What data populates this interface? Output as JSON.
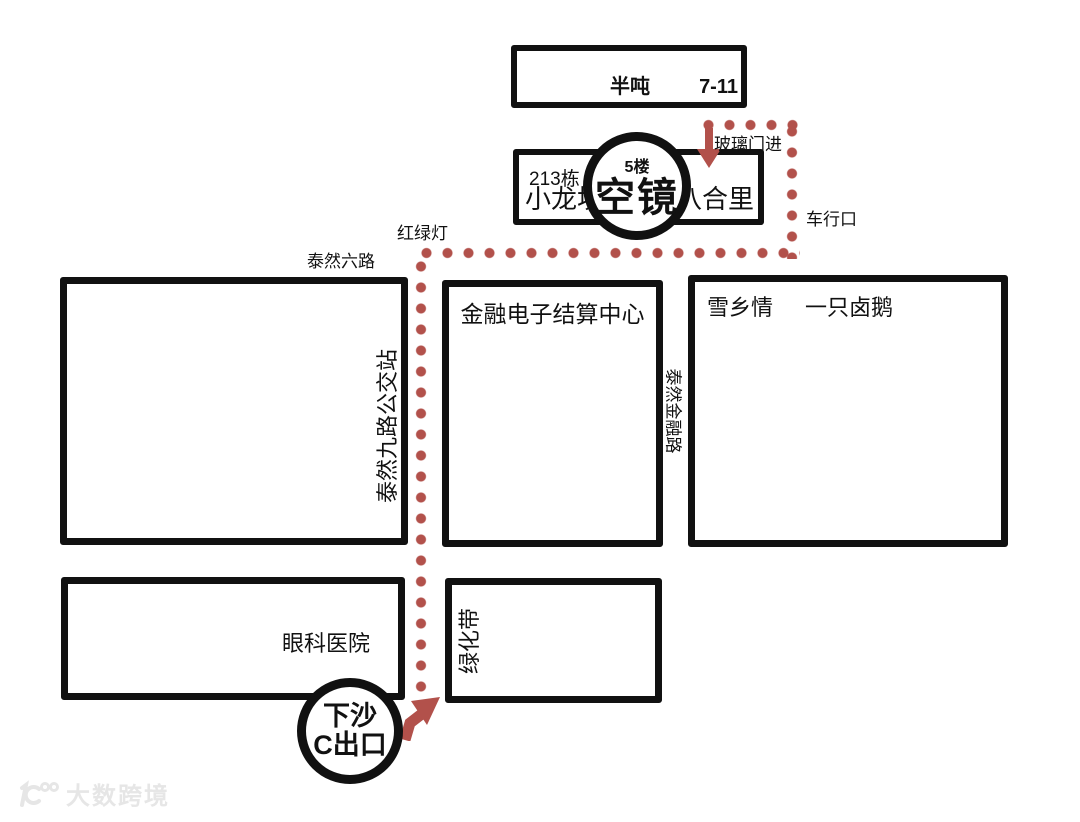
{
  "buildings": {
    "bandun_block": {
      "store_left": "半吨",
      "store_right": "7-11"
    },
    "block213": {
      "number": "213栋",
      "store_left": "小龙坎",
      "store_right": "八合里"
    },
    "venue": {
      "floor": "5楼",
      "name": "空镜"
    },
    "bus_block": {
      "label": "泰然九路公交站"
    },
    "finance_center": {
      "label": "金融电子结算中心"
    },
    "goose_block": {
      "name1": "雪乡情",
      "name2": "一只卤鹅"
    },
    "hospital": {
      "label": "眼科医院"
    },
    "green_belt": {
      "label": "绿化带"
    }
  },
  "roads": {
    "tairan6": "泰然六路",
    "tairan_finance": "泰然金融路"
  },
  "route_labels": {
    "traffic_light": "红绿灯",
    "glass_door": "玻璃门进",
    "car_entrance": "车行口"
  },
  "metro_exit": {
    "line1": "下沙",
    "line2": "C出口"
  },
  "watermark": {
    "brand": "大数跨境",
    "logo": "100-logo"
  },
  "colors": {
    "route": "#b2514b",
    "outline": "#111111"
  }
}
